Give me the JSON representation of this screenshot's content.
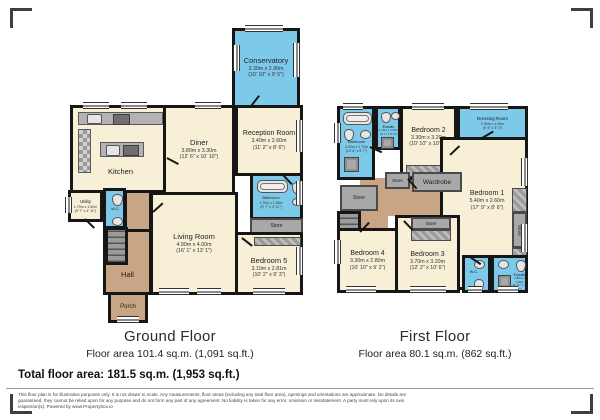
{
  "colors": {
    "cream": "#F7EFD6",
    "wet": "#7CC9EA",
    "hall": "#C8A585",
    "closet": "#A8A8A8",
    "wall": "#161616"
  },
  "ground_floor": {
    "title": "Ground Floor",
    "area_label": "Floor area 101.4 sq.m. (1,091 sq.ft.)",
    "rooms": {
      "conservatory": {
        "name": "Conservatory",
        "metric": "3.30m x 2.90m",
        "imperial": "(10' 10\" x 9' 6\")"
      },
      "kitchen": {
        "name": "Kitchen"
      },
      "diner": {
        "name": "Diner",
        "metric": "3.80m x 3.30m",
        "imperial": "(12' 6\" x 10' 10\")"
      },
      "reception_room": {
        "name": "Reception Room",
        "metric": "3.40m x 2.60m",
        "imperial": "(11' 2\" x 8' 6\")"
      },
      "bathroom": {
        "name": "Bathroom",
        "metric": "1.70m x 1.50m",
        "imperial": "(5' 7\" x 4' 11\")"
      },
      "store": {
        "name": "Store"
      },
      "bedroom5": {
        "name": "Bedroom 5",
        "metric": "3.10m x 2.81m",
        "imperial": "(10' 2\" x 9' 3\")"
      },
      "living_room": {
        "name": "Living Room",
        "metric": "4.90m x 4.00m",
        "imperial": "(16' 1\" x 13' 1\")"
      },
      "utility": {
        "name": "Utility",
        "metric": "1.70m x 1.50m",
        "imperial": "(5' 7\" x 4' 11\")"
      },
      "wc": {
        "name": "W.C."
      },
      "hall": {
        "name": "Hall"
      },
      "porch": {
        "name": "Porch"
      }
    }
  },
  "first_floor": {
    "title": "First Floor",
    "area_label": "Floor area 80.1 sq.m. (862 sq.ft.)",
    "rooms": {
      "bathroom": {
        "name": "Bathroom",
        "metric": "3.20m x 1.70m",
        "imperial": "(10' 6\" x 5' 7\")"
      },
      "ensuite_top": {
        "name": "Ensuite",
        "metric": "1.10m x 1.00m",
        "imperial": "(3' 7\" x 3' 3\")"
      },
      "bedroom2": {
        "name": "Bedroom 2",
        "metric": "3.30m x 3.20m",
        "imperial": "(10' 10\" x 10' 6\")"
      },
      "dressing_room": {
        "name": "Dressing Room",
        "metric": "2.90m x 1.00m",
        "imperial": "(9' 6\" x 3' 3\")"
      },
      "bedroom1": {
        "name": "Bedroom 1",
        "metric": "5.40m x 2.60m",
        "imperial": "(17' 9\" x 8' 6\")"
      },
      "wardrobe": {
        "name": "Wardrobe"
      },
      "store_left": {
        "name": "Store"
      },
      "store_mid": {
        "name": "Store"
      },
      "store_b3": {
        "name": "Store"
      },
      "store_right": {
        "name": "Store"
      },
      "bedroom3": {
        "name": "Bedroom 3",
        "metric": "3.70m x 3.20m",
        "imperial": "(12' 2\" x 10' 6\")"
      },
      "bedroom4": {
        "name": "Bedroom 4",
        "metric": "3.30m x 2.80m",
        "imperial": "(10' 10\" x 9' 2\")"
      },
      "wc": {
        "name": "W.C."
      },
      "ensuite_bottom": {
        "name": "Ensuite",
        "metric": "1.80m x 1.30m",
        "imperial": "(5' 11\" x 4' 3\")"
      }
    }
  },
  "summary": {
    "total_area": "Total floor area: 181.5 sq.m. (1,953 sq.ft.)"
  },
  "disclaimer": "This floor plan is for illustrative purposes only. It is not drawn to scale. Any measurements, floor areas (including any total floor area), openings and orientations are approximate. No details are guaranteed, they cannot be relied upon for any purpose and do not form any part of any agreement. No liability is taken for any error, omission or misstatement. A party must rely upon its own inspection(s). Powered by www.Propertybox.io"
}
